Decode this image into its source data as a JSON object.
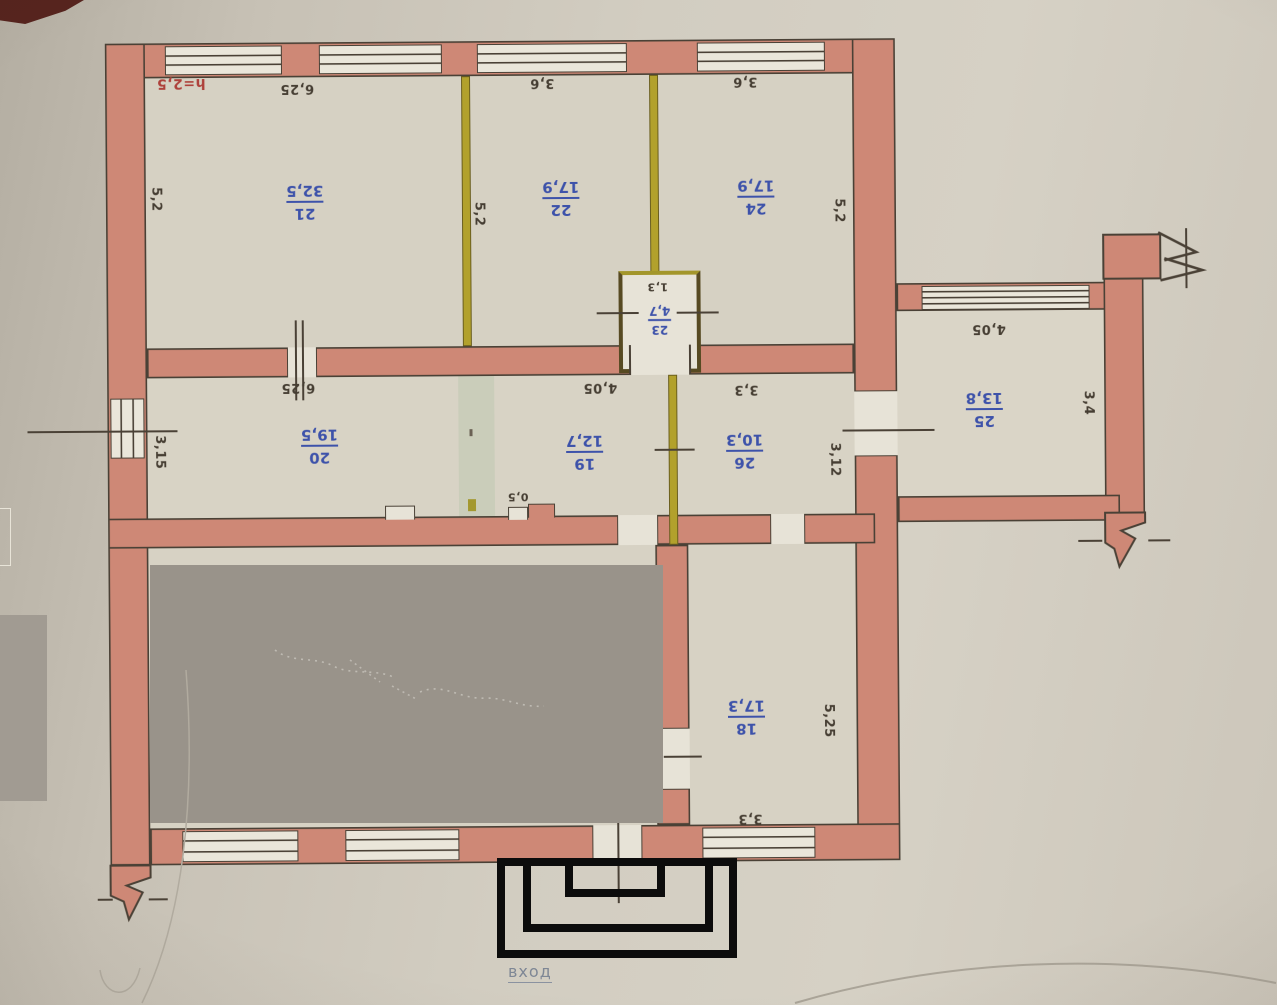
{
  "document": {
    "type_label": "floor plan photograph",
    "orientation": "plan text appears rotated 180 degrees"
  },
  "notes": {
    "ceiling_height": "h=2,5",
    "entrance": "вход"
  },
  "rooms": [
    {
      "number": "21",
      "area": "32,5"
    },
    {
      "number": "22",
      "area": "17,9"
    },
    {
      "number": "24",
      "area": "17,9"
    },
    {
      "number": "23",
      "area": "4,7"
    },
    {
      "number": "20",
      "area": "19,5"
    },
    {
      "number": "19",
      "area": "12,7"
    },
    {
      "number": "26",
      "area": "10,3"
    },
    {
      "number": "25",
      "area": "13,8"
    },
    {
      "number": "18",
      "area": "17,3"
    }
  ],
  "dimensions": [
    {
      "text": "6,25",
      "location": "room-21-top"
    },
    {
      "text": "3,6",
      "location": "room-22-top"
    },
    {
      "text": "3,6",
      "location": "room-24-top"
    },
    {
      "text": "5,2",
      "location": "room-21-left"
    },
    {
      "text": "5,2",
      "location": "partition-21-22"
    },
    {
      "text": "5,2",
      "location": "room-24-right"
    },
    {
      "text": "1,3",
      "location": "room-23"
    },
    {
      "text": "6,25",
      "location": "room-20-top"
    },
    {
      "text": "4,05",
      "location": "room-19-top"
    },
    {
      "text": "3,3",
      "location": "room-26-top"
    },
    {
      "text": "3,15",
      "location": "room-20-left"
    },
    {
      "text": "3,12",
      "location": "room-26-right"
    },
    {
      "text": "4,05",
      "location": "room-25-top"
    },
    {
      "text": "3,4",
      "location": "room-25-right"
    },
    {
      "text": "0,5",
      "location": "corridor-wall-step"
    },
    {
      "text": "5,25",
      "location": "room-18-right"
    },
    {
      "text": "3,3",
      "location": "room-18-bottom"
    }
  ],
  "colors": {
    "wall": "#ce8876",
    "outline": "#4a4136",
    "light_partition": "#b2a12c",
    "paper": "#ccc6ba",
    "floor": "#d8d3c5",
    "room_label": "#3d52aa",
    "dimension_text": "#463e33",
    "height_note": "#ae413b",
    "redaction": "#99938a",
    "porch_outline": "#0c0c0c",
    "entrance_text": "#7e8795"
  }
}
